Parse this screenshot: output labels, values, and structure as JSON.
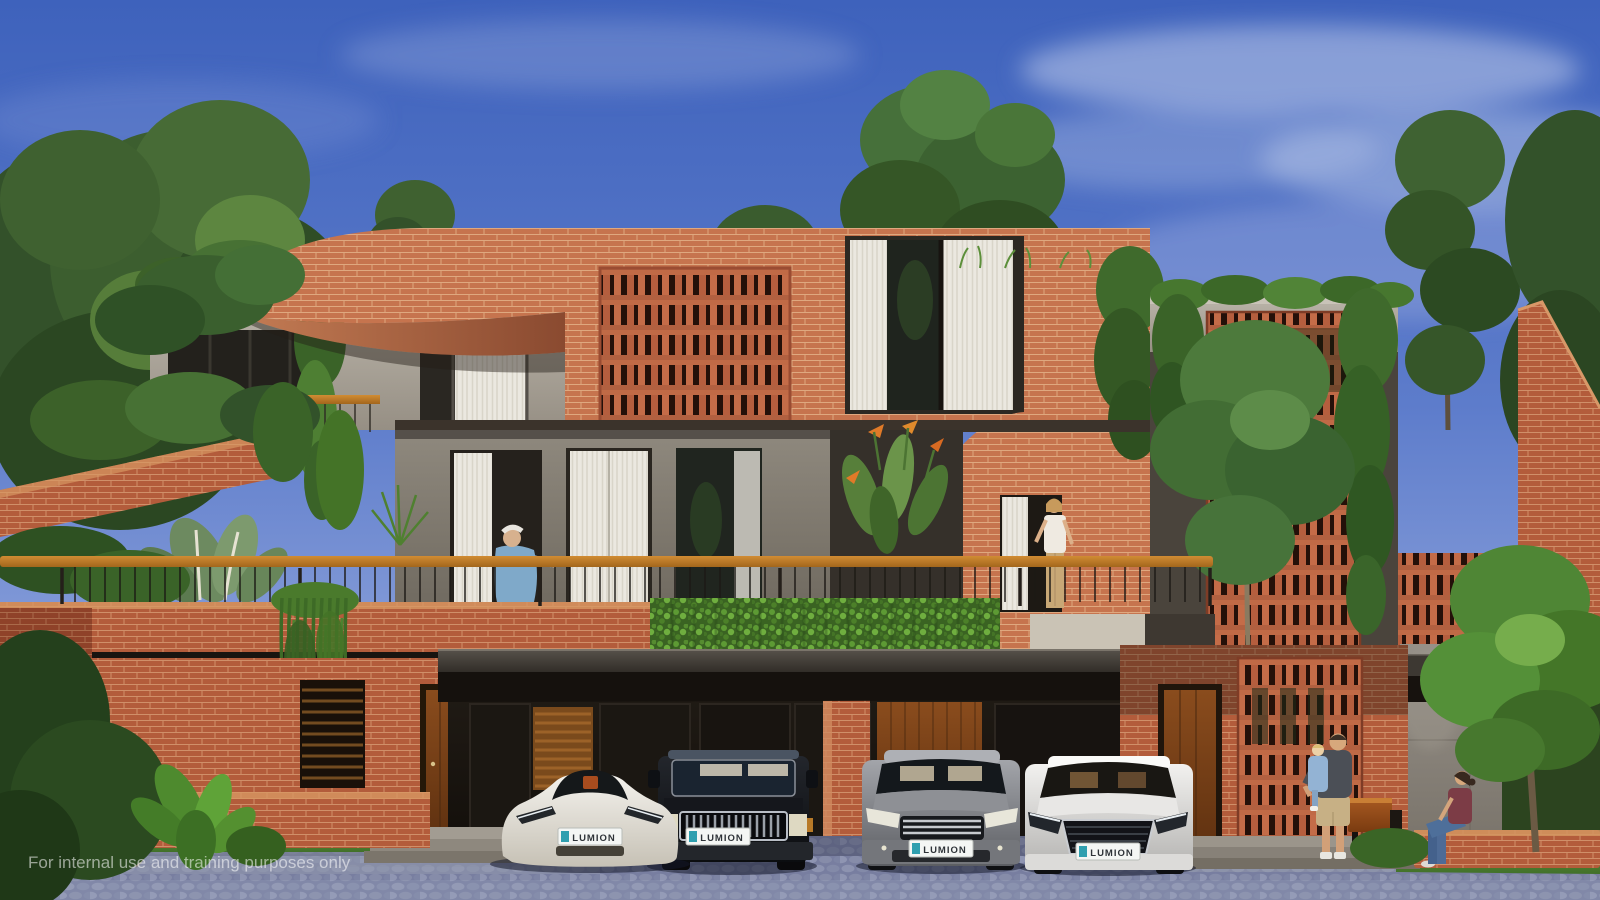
{
  "image": {
    "type": "architectural-exterior-3d-render",
    "watermark": "For internal use and training purposes only",
    "house_number": "1A"
  },
  "vehicles": [
    {
      "name": "white-roadster",
      "plate": "LUMION"
    },
    {
      "name": "black-suv",
      "plate": "LUMION"
    },
    {
      "name": "gray-sedan",
      "plate": "LUMION"
    },
    {
      "name": "white-sedan",
      "plate": "LUMION"
    }
  ],
  "people": [
    {
      "name": "elderly-man-on-balcony"
    },
    {
      "name": "woman-on-balcony"
    },
    {
      "name": "man-holding-child"
    },
    {
      "name": "woman-sitting-on-wall"
    }
  ],
  "palette": {
    "sky_top": "#3e62bc",
    "sky_horizon": "#a8b6e4",
    "brick_lit": "#c6744e",
    "brick_mid": "#b35c3b",
    "concrete": "#a49d92",
    "foliage": "#4c8029",
    "wood_rail": "#c07a2c",
    "canopy_dark": "#171310",
    "cobblestone": "#7d84a4",
    "plate_badge_teal": "#2f9faf"
  }
}
